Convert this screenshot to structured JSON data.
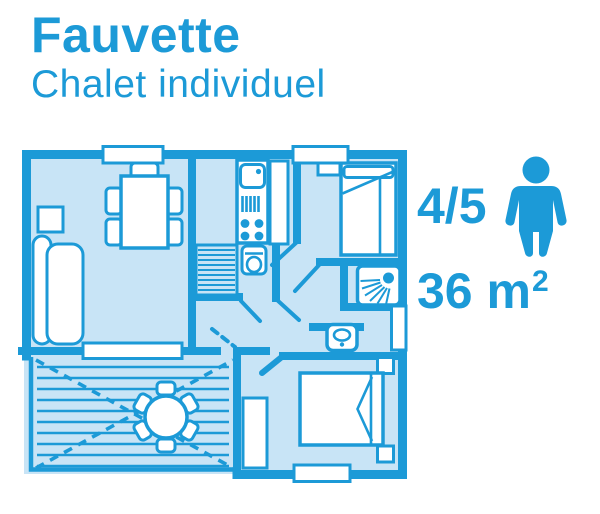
{
  "header": {
    "title": "Fauvette",
    "subtitle": "Chalet individuel"
  },
  "details": {
    "capacity": "4/5",
    "capacity_icon": "person-icon",
    "area": "36 m",
    "area_exponent": "2"
  },
  "colors": {
    "accent": "#1c9ad7",
    "floor": "#c8e4f6",
    "furniture": "#ffffff",
    "background": "#ffffff"
  }
}
